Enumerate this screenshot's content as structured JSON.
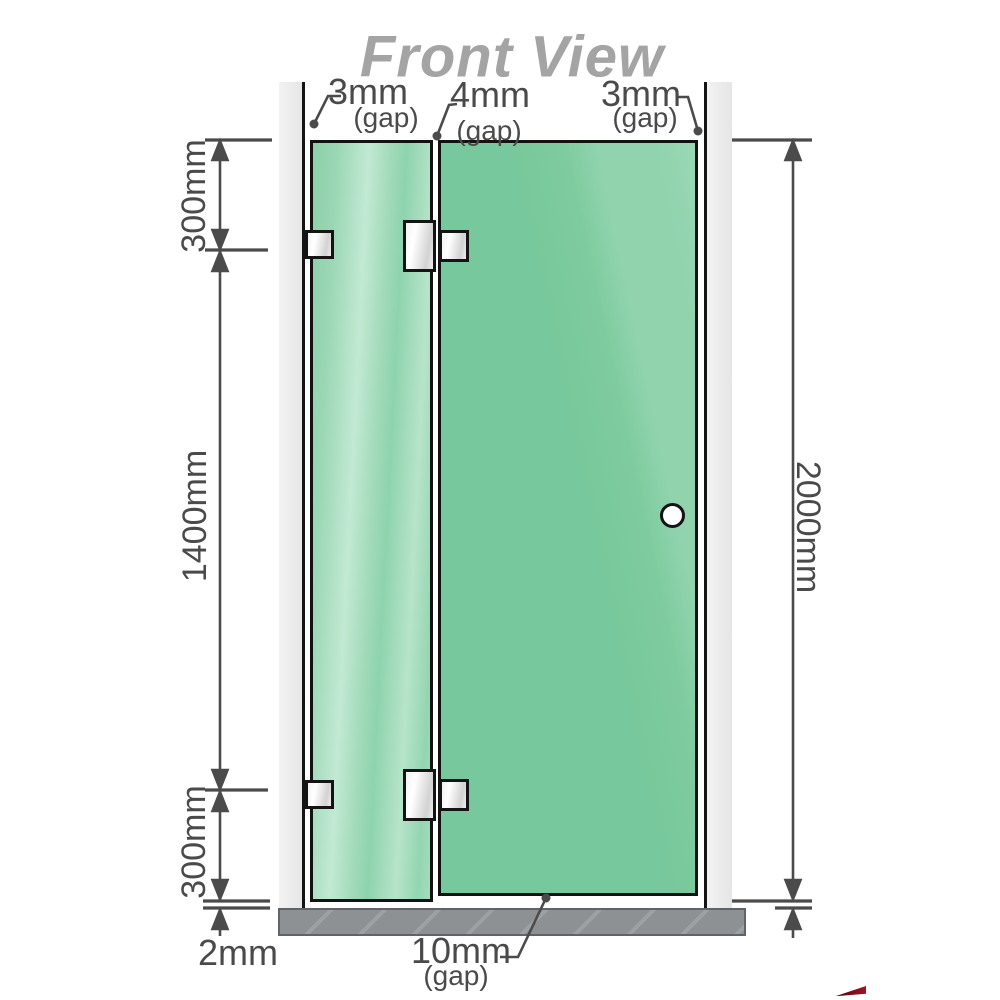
{
  "title": "Front View",
  "colors": {
    "glass_green": "#7bc99e",
    "glass_highlight": "#c2e9d3",
    "wall_gray": "#ececec",
    "floor_gray": "#8d9194",
    "outline_black": "#141414",
    "dimension_gray": "#4b4b4b",
    "title_gray": "#a4a4a4",
    "hardware_silver": "#e9e9e9",
    "brand_red": "#8e1522"
  },
  "gaps": {
    "left": {
      "value": "3mm",
      "note": "(gap)"
    },
    "middle": {
      "value": "4mm",
      "note": "(gap)"
    },
    "right": {
      "value": "3mm",
      "note": "(gap)"
    },
    "bottom_door": {
      "value": "10mm",
      "note": "(gap)"
    },
    "bottom_floor": {
      "value": "2mm"
    }
  },
  "dimensions": {
    "left_top": "300mm",
    "left_middle": "1400mm",
    "left_bottom": "300mm",
    "right_total": "2000mm"
  }
}
